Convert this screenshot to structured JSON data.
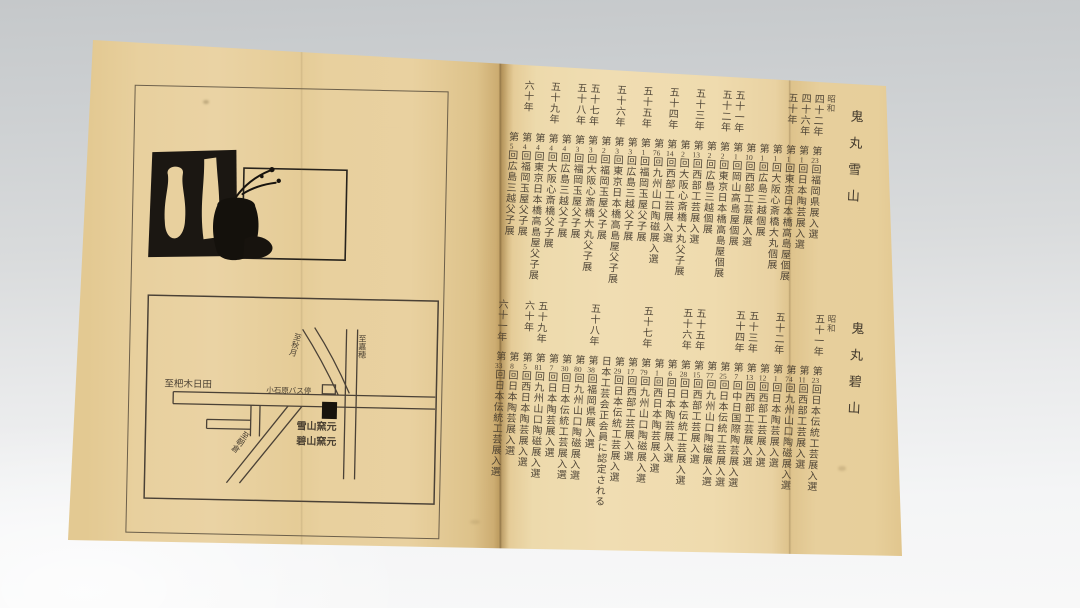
{
  "pamphlet": {
    "paper_color": "#ead3a4",
    "ink_color": "#3e352a",
    "sections": [
      {
        "id": "setsuzan",
        "artist": "鬼丸雪山",
        "era": "昭和",
        "groups": [
          {
            "year": "四十二年",
            "entries": [
              "第23回福岡県展入選"
            ]
          },
          {
            "year": "四十六年",
            "entries": [
              "第1回日本陶芸展入選"
            ]
          },
          {
            "year": "五十年",
            "entries": [
              "第1回東京日本橋高島屋個展",
              "第1回大阪心斎橋大丸個展",
              "第1回広島三越個展",
              "第10回西部工芸展入選"
            ]
          },
          {
            "year": "五十一年",
            "entries": [
              "第1回岡山高島屋個展"
            ]
          },
          {
            "year": "五十二年",
            "entries": [
              "第2回東京日本橋高島屋個展",
              "第2回広島三越個展"
            ]
          },
          {
            "year": "五十三年",
            "entries": [
              "第13回西部工芸展入選",
              "第2回大阪心斎橋大丸父子展"
            ]
          },
          {
            "year": "五十四年",
            "entries": [
              "第14回西部工芸展入選",
              "第76回九州山口陶磁展入選"
            ]
          },
          {
            "year": "五十五年",
            "entries": [
              "第1回福岡玉屋父子展",
              "第3回広島三越父子展"
            ]
          },
          {
            "year": "五十六年",
            "entries": [
              "第3回東京日本橋高島屋父子展",
              "第2回福岡玉屋父子展"
            ]
          },
          {
            "year": "五十七年",
            "entries": [
              "第3回大阪心斎橋大丸父子展"
            ]
          },
          {
            "year": "五十八年",
            "entries": [
              "第3回福岡玉屋父子展",
              "第4回広島三越父子展"
            ]
          },
          {
            "year": "五十九年",
            "entries": [
              "第4回大阪心斎橋父子展",
              "第4回東京日本橋高島屋父子展"
            ]
          },
          {
            "year": "六十年",
            "entries": [
              "第4回福岡玉屋父子展",
              "第5回広島三越父子展"
            ]
          }
        ]
      },
      {
        "id": "hekizan",
        "artist": "鬼丸碧山",
        "era": "昭和",
        "groups": [
          {
            "year": "五十一年",
            "entries": [
              "第23回日本伝統工芸展入選",
              "第11回西部工芸展入選",
              "第74回九州山口陶磁展入選"
            ]
          },
          {
            "year": "五十二年",
            "entries": [
              "第1回日本陶芸展入選",
              "第12回西部工芸展入選"
            ]
          },
          {
            "year": "五十三年",
            "entries": [
              "第13回西部工芸展入選"
            ]
          },
          {
            "year": "五十四年",
            "entries": [
              "第7回中日国際陶芸展入選",
              "第25回日本伝統工芸展入選",
              "第77回九州山口陶磁展入選"
            ]
          },
          {
            "year": "五十五年",
            "entries": [
              "第15回西部工芸展入選"
            ]
          },
          {
            "year": "五十六年",
            "entries": [
              "第28回日本伝統工芸展入選",
              "第6回日本陶芸展入選",
              "第1回西日本陶芸展入選"
            ]
          },
          {
            "year": "五十七年",
            "entries": [
              "第79回九州山口陶磁展入選",
              "第17回西部工芸展入選",
              "第29回日本伝統工芸展入選",
              "日本工芸会正会員に認定される"
            ]
          },
          {
            "year": "五十八年",
            "entries": [
              "第38回福岡県展入選",
              "第80回九州山口陶磁展入選",
              "第30回日本伝統工芸展入選",
              "第7回日本陶芸展入選"
            ]
          },
          {
            "year": "五十九年",
            "entries": [
              "第81回九州山口陶磁展入選"
            ]
          },
          {
            "year": "六十年",
            "entries": [
              "第5回西日本陶芸展入選",
              "第8回日本陶芸展入選"
            ]
          },
          {
            "year": "六十一年",
            "entries": [
              "第33回日本伝統工芸展入選"
            ]
          }
        ]
      }
    ],
    "map": {
      "labels": {
        "road_left": "至杷木日田",
        "road_curve": "至秋月",
        "road_right": "至嘉穂",
        "road_diagonal": "至朝倉",
        "bus_stop": "小石原バス停",
        "kiln_line1": "雪山窯元",
        "kiln_line2": "碧山窯元"
      }
    }
  }
}
